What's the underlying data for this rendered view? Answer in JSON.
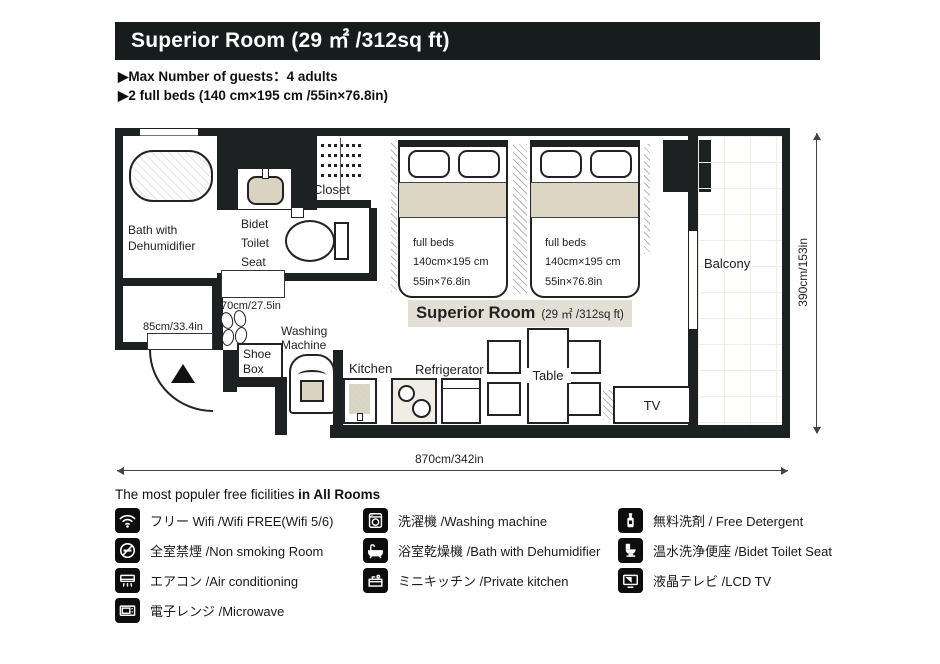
{
  "header": {
    "title": "Superior Room (29 ㎡ /312sq ft)",
    "bullet1": "▶Max Number of guests：4 adults",
    "bullet2": "▶2 full beds (140 cm×195 cm /55in×76.8in)"
  },
  "floorplan": {
    "bath_label": "Bath with Dehumidifier",
    "bidet_label_1": "Bidet",
    "bidet_label_2": "Toilet",
    "bidet_label_3": "Seat",
    "closet_label": "Closet",
    "balcony_label": "Balcony",
    "bed": {
      "l1": "full beds",
      "l2": "140cm×195 cm",
      "l3": "55in×76.8in"
    },
    "room_label_name": "Superior Room",
    "room_label_size": "(29 ㎡ /312sq ft)",
    "shoe_box": "Shoe Box",
    "washing_machine": "Washing Machine",
    "kitchen": "Kitchen",
    "refrigerator": "Refrigerator",
    "table": "Table",
    "tv": "TV",
    "dim_toilet_door": "70cm/27.5in",
    "dim_entrance": "85cm/33.4in",
    "dim_width": "870cm/342in",
    "dim_height": "390cm/153in"
  },
  "facilities": {
    "heading_normal": "The most populer free ficilities ",
    "heading_bold": "in All Rooms",
    "col1": [
      {
        "icon": "wifi-icon",
        "label": "フリー Wifi /Wifi FREE(Wifi 5/6)"
      },
      {
        "icon": "no-smoking-icon",
        "label": "全室禁煙 /Non smoking Room"
      },
      {
        "icon": "air-conditioner-icon",
        "label": "エアコン /Air conditioning"
      },
      {
        "icon": "microwave-icon",
        "label": "電子レンジ /Microwave"
      }
    ],
    "col2": [
      {
        "icon": "washing-machine-icon",
        "label": "洗濯機 /Washing machine"
      },
      {
        "icon": "bathtub-icon",
        "label": "浴室乾燥機 /Bath with Dehumidifier"
      },
      {
        "icon": "kitchen-icon",
        "label": "ミニキッチン /Private kitchen"
      }
    ],
    "col3": [
      {
        "icon": "detergent-icon",
        "label": "無料洗剤 / Free Detergent"
      },
      {
        "icon": "bidet-toilet-icon",
        "label": "温水洗浄便座 /Bidet Toilet Seat"
      },
      {
        "icon": "lcd-tv-icon",
        "label": "液晶テレビ /LCD TV"
      }
    ]
  },
  "colors": {
    "wall": "#1d2121",
    "beige": "#dbd7c4",
    "label_bg": "#e2e0d5",
    "title_bg": "#171c1c"
  }
}
